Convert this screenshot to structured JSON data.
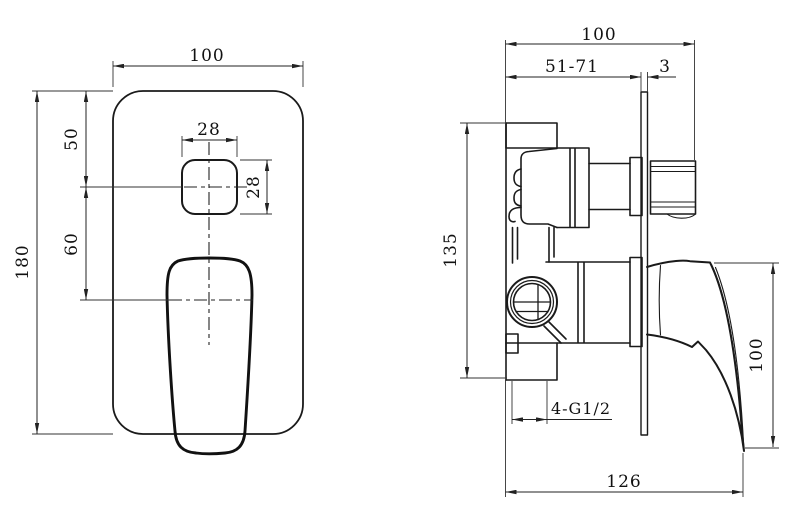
{
  "colors": {
    "line": "#1a1a1a",
    "background": "#ffffff"
  },
  "front_view": {
    "dims": {
      "plate_width": "100",
      "plate_height": "180",
      "plate_top_to_diverter_center": "50",
      "diverter_center_to_handle_center": "60",
      "diverter_cutout_width": "28",
      "diverter_cutout_height": "28"
    }
  },
  "side_view": {
    "dims": {
      "overall_depth": "100",
      "rough_in_range": "51-71",
      "plate_thickness": "3",
      "body_height": "135",
      "handle_height": "100",
      "overall_height": "126",
      "inlet_thread": "4-G1/2"
    }
  }
}
